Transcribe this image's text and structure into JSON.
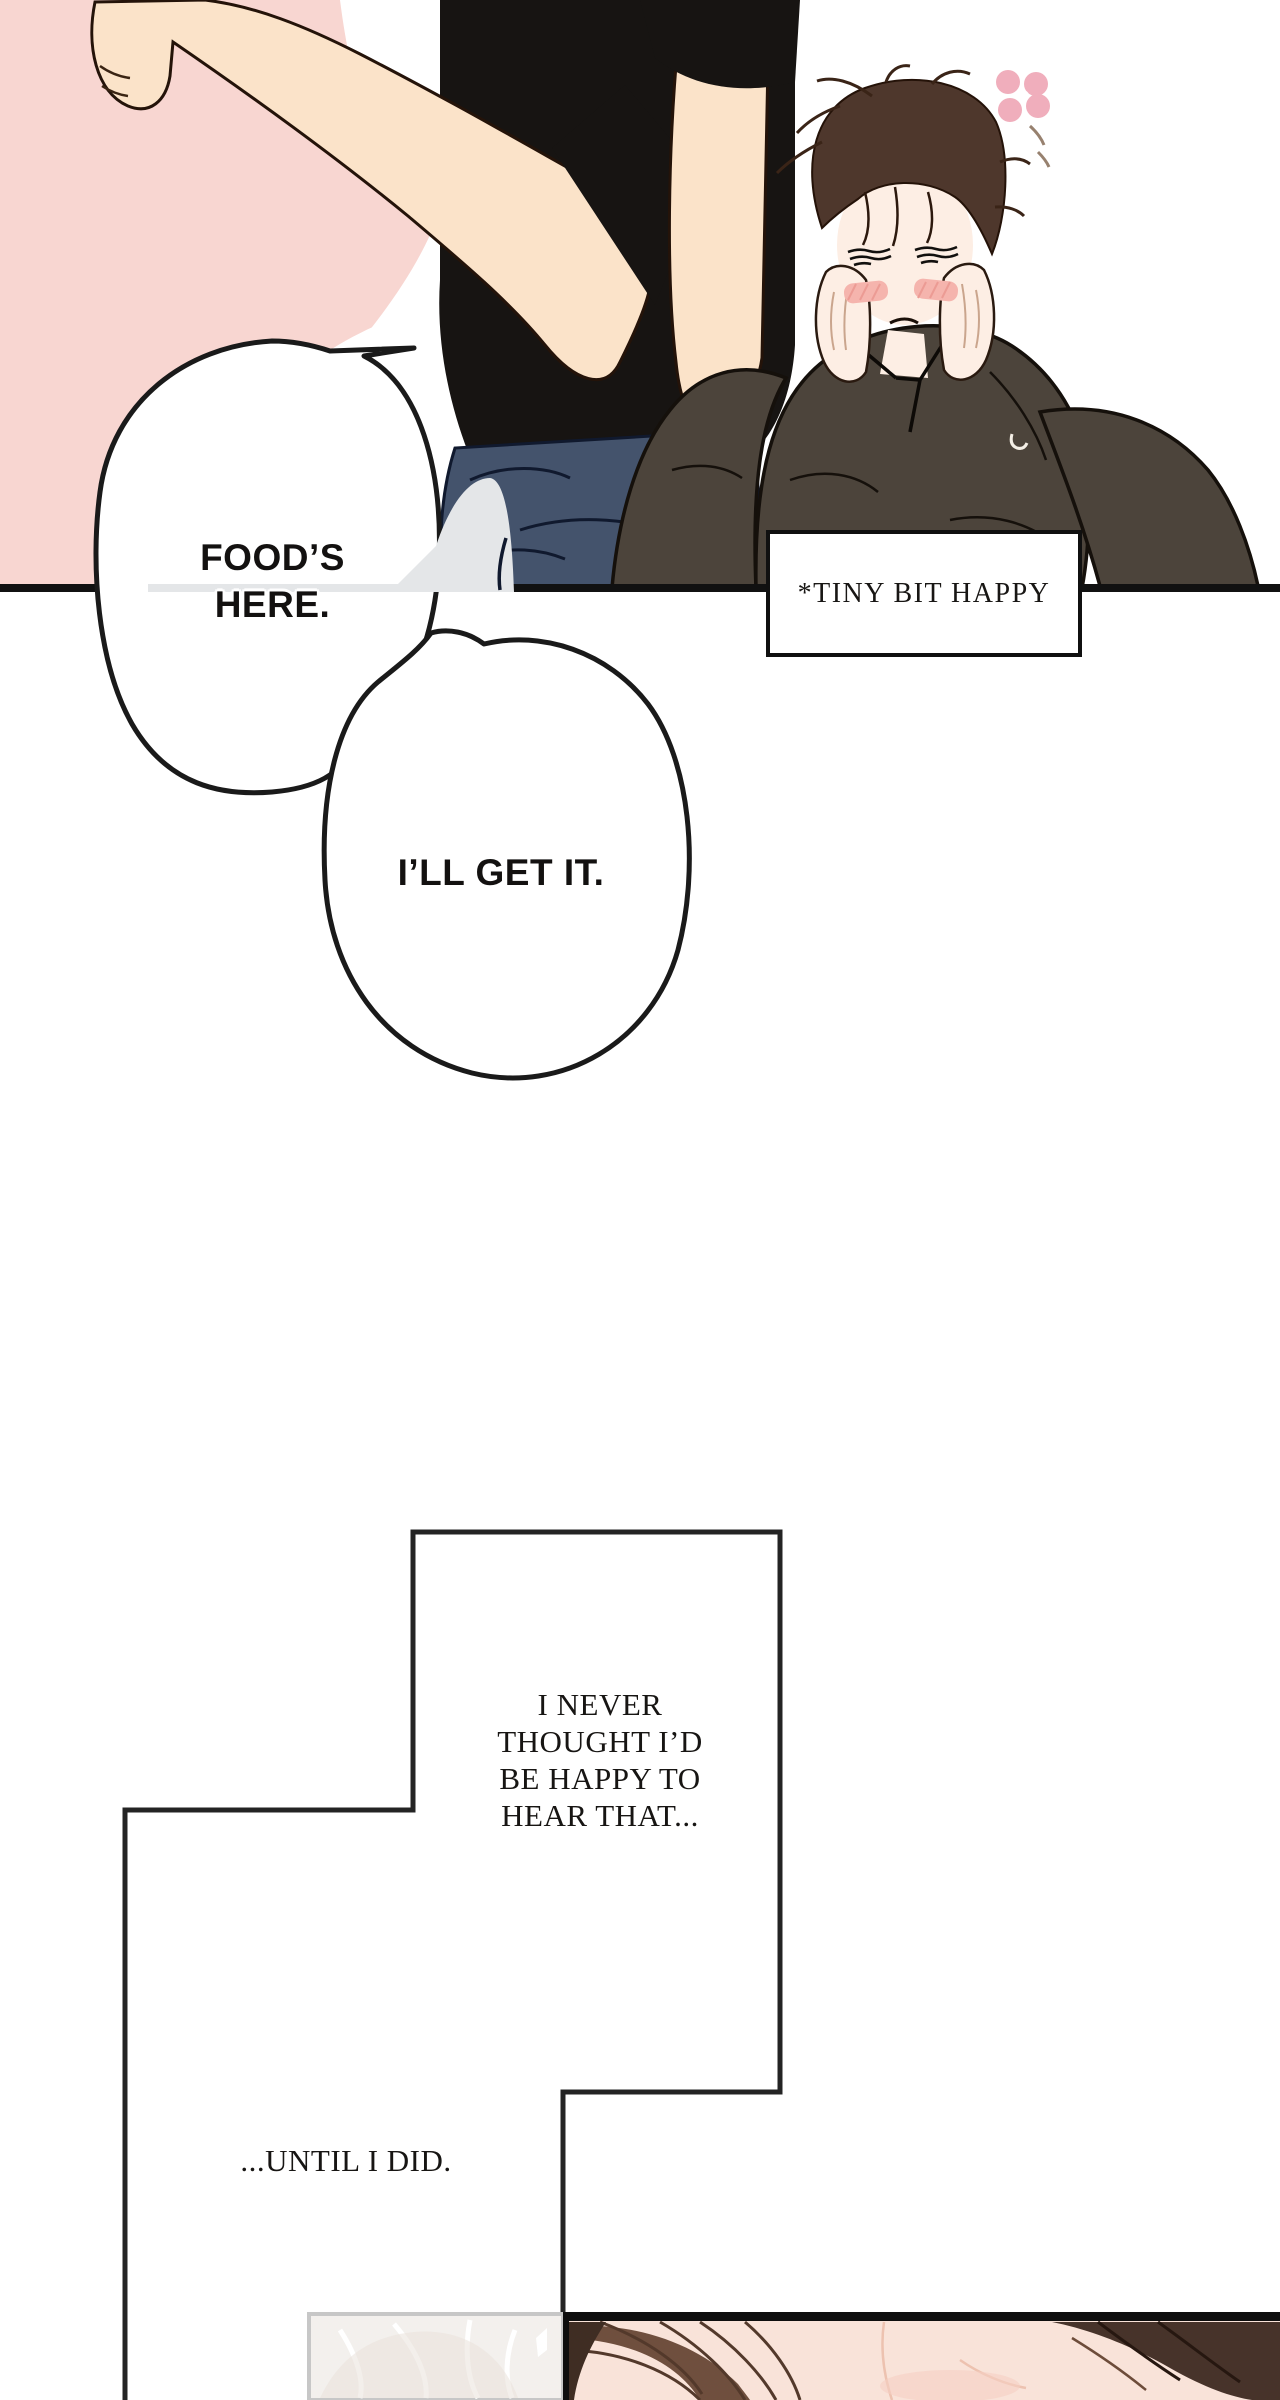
{
  "page": {
    "width": 1280,
    "height": 2400,
    "background": "#ffffff"
  },
  "panel_top": {
    "speech_bubbles": [
      {
        "text": "FOOD’S\nHERE."
      },
      {
        "text": "I’LL GET IT."
      }
    ],
    "caption": {
      "text": "*TINY BIT HAPPY"
    }
  },
  "narration": {
    "thought": "I NEVER\nTHOUGHT I’D\nBE HAPPY TO\nHEAR THAT...",
    "tail": "...UNTIL I DID."
  },
  "palette": {
    "pink_bg": "#f8d6d1",
    "arm_skin": "#fbe3c9",
    "face_skin": "#fdeee4",
    "tee_black": "#171412",
    "jeans_blue": "#44536c",
    "shirt_taupe": "#4c443b",
    "hair_brown": "#4e372c",
    "blush_pink": "#f5b4ad",
    "flower_pink": "#f0aebc",
    "dome_gray": "#e4e6e8",
    "line_black": "#111111",
    "panel_line": "#242424",
    "memory_box_fill": "#f3f0ed",
    "memory_box_border": "#c7c7c7",
    "kiss_skin": "#f9e3d9",
    "kiss_hair_dark": "#47332a",
    "kiss_hair_mid": "#6f4f3e",
    "kiss_border_black": "#0e0e0e"
  }
}
